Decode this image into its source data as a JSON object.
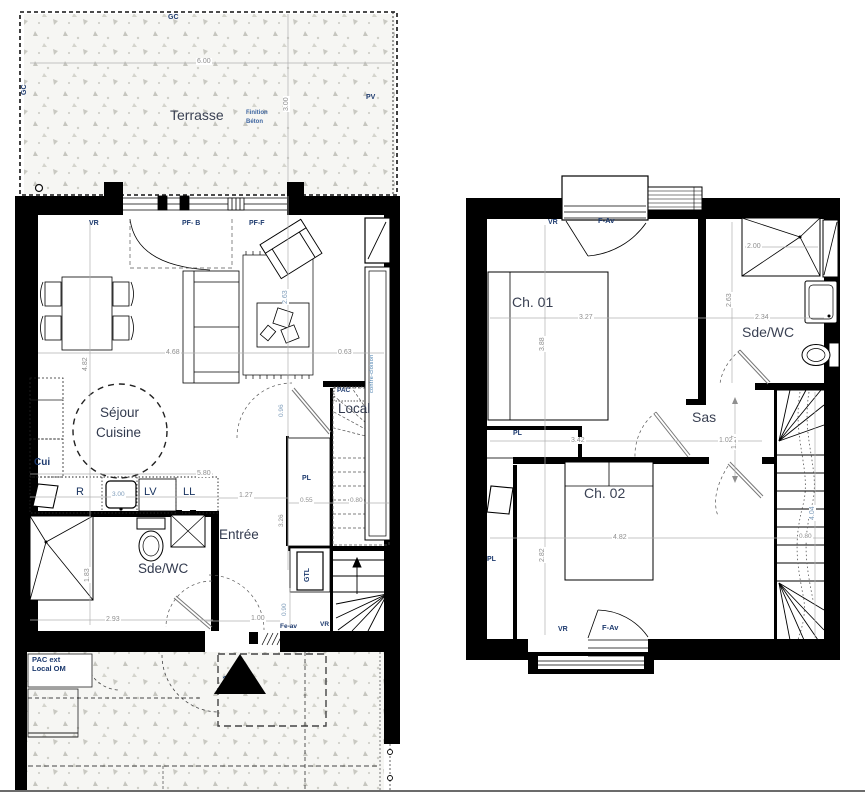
{
  "colors": {
    "wall": "#000000",
    "dim": "#8f8f8f",
    "dim_blue": "#7e9cba",
    "code": "#1d3a6e",
    "room": "#323a4e",
    "concrete_bg": "#f6f6f3"
  },
  "gf": {
    "terrace": {
      "title": "Terrasse",
      "gc_top": "GC",
      "gc_left": "GC",
      "pv": "PV",
      "finition_1": "Finition",
      "finition_2": "Béton",
      "dim_width": "6.00",
      "dim_depth": "3.00"
    },
    "living": {
      "vr": "VR",
      "pf_b": "PF- B",
      "pf_f": "PF-F",
      "contre_cloison": "contre-cloison",
      "dim_width": "4.68",
      "dim_right": "0.63",
      "dim_height": "4.82",
      "dim_mid": "2.63"
    },
    "kitchen": {
      "room_1": "Séjour",
      "room_2": "Cuisine",
      "cui": "Cui",
      "fridge": "R",
      "sink_dim": "3.00",
      "dishwasher": "LV",
      "washer": "LL",
      "dim_width": "5.80"
    },
    "bathroom": {
      "name": "Sde/WC",
      "dim_height": "1.83",
      "dim_width": "2.93"
    },
    "entry": {
      "name": "Entrée",
      "dim_top": "1.27",
      "dim_door": "1.00",
      "dim_side": "0.90",
      "fe_av": "Fe-av",
      "vr": "VR"
    },
    "closet": {
      "pl": "PL",
      "dim": "0.55",
      "gtl": "GTL",
      "dim_v1": "0.96",
      "dim_v2": "3.26"
    },
    "stairs": {
      "dim_width": "0.80"
    },
    "local": {
      "name": "Local",
      "pac": "PAC"
    },
    "exterior": {
      "pac_ext_1": "PAC ext",
      "pac_ext_2": "Local OM",
      "unit_number": "2002"
    }
  },
  "uf": {
    "ch01": {
      "name": "Ch. 01",
      "vr": "VR",
      "f_av": "F-Av",
      "dim_width": "3.27",
      "dim_height": "3.88"
    },
    "bathroom": {
      "name": "Sde/WC",
      "dim_shower": "2.00",
      "dim_height": "2.63",
      "dim_width": "2.34"
    },
    "sas": {
      "name": "Sas",
      "dim_height": "1.17",
      "dim_width": "1.02"
    },
    "ch02": {
      "name": "Ch. 02",
      "dim_width": "4.82",
      "dim_height": "2.82",
      "dim_top": "3.42",
      "pl_top": "PL",
      "pl_side": "PL",
      "vr": "VR",
      "f_av": "F-Av"
    },
    "stairs": {
      "dim_height": "4.04",
      "dim_width": "0.80"
    }
  }
}
